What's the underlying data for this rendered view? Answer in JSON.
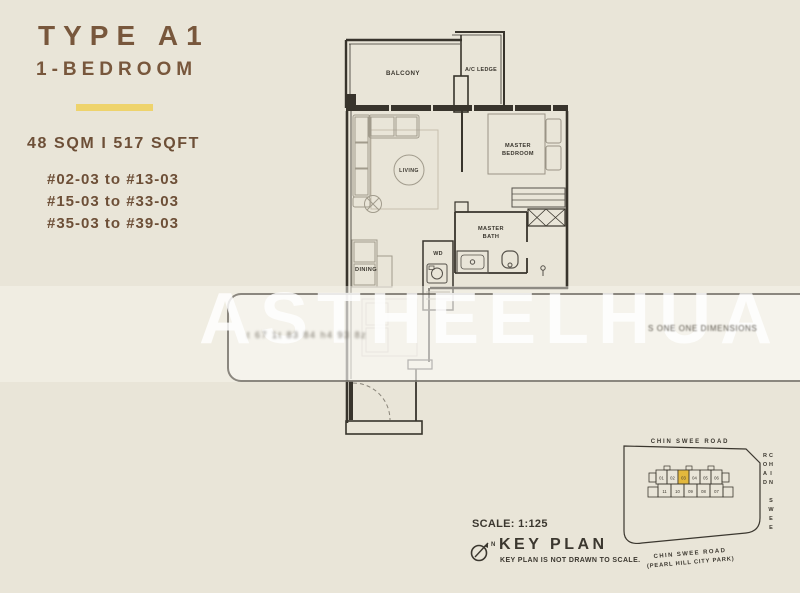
{
  "info": {
    "type_title": "TYPE A1",
    "subtitle": "1-BEDROOM",
    "area": "48 SQM  I  517 SQFT",
    "units": [
      "#02-03 to #13-03",
      "#15-03 to #33-03",
      "#35-03 to #39-03"
    ]
  },
  "plan": {
    "labels": {
      "balcony": "BALCONY",
      "ac_ledge": "A/C LEDGE",
      "living": "LIVING",
      "master_line1": "MASTER",
      "bedroom_line2": "BEDROOM",
      "bath_line1": "MASTER",
      "bath_line2": "BATH",
      "dining": "DINING",
      "wd": "WD"
    }
  },
  "watermark": {
    "text": "ASTHEELHUA",
    "stamp_left": "t 67 1t 83 84 h4 93 8z",
    "stamp_right": "S ONE ONE DIMENSIONS"
  },
  "captions": {
    "scale": "SCALE: 1:125",
    "key_plan_title": "KEY PLAN",
    "key_plan_note": "KEY PLAN IS NOT DRAWN TO SCALE.",
    "north_letter": "N"
  },
  "key_plan": {
    "road_top": "CHIN SWEE ROAD",
    "road_right": "CHIN SWEE ROAD",
    "road_bottom_line1": "CHIN SWEE ROAD",
    "road_bottom_line2": "(PEARL HILL CITY PARK)",
    "highlighted_unit": "03",
    "units_top": [
      "01",
      "02",
      "03",
      "04",
      "05",
      "06"
    ],
    "units_bottom": [
      "11",
      "10",
      "09",
      "08",
      "07"
    ]
  }
}
